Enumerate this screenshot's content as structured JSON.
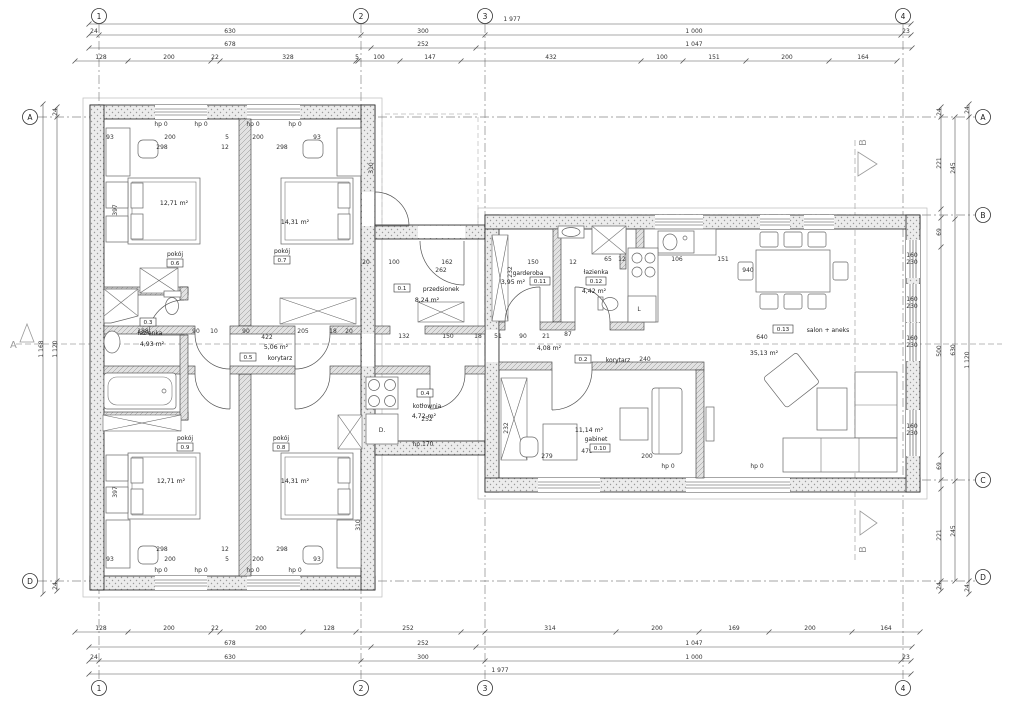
{
  "axes": {
    "cols": [
      "1",
      "2",
      "3",
      "4"
    ],
    "rows": [
      "A",
      "B",
      "C",
      "D"
    ]
  },
  "sections": {
    "a": "A",
    "b": "B"
  },
  "rooms": [
    {
      "id": "0.1",
      "name": "przedsionek",
      "area": "8,24 m²"
    },
    {
      "id": "0.2",
      "name": "korytarz",
      "area": "4,08 m²"
    },
    {
      "id": "0.3",
      "name": "łazienka",
      "area": "4,93 m²"
    },
    {
      "id": "0.4",
      "name": "kotłownia",
      "area": "4,72 m²"
    },
    {
      "id": "0.5",
      "name": "korytarz",
      "area": "5,06 m²"
    },
    {
      "id": "0.6",
      "name": "pokój",
      "area": "12,71 m²"
    },
    {
      "id": "0.7",
      "name": "pokój",
      "area": "14,31 m²"
    },
    {
      "id": "0.8",
      "name": "pokój",
      "area": "14,31 m²"
    },
    {
      "id": "0.9",
      "name": "pokój",
      "area": "12,71 m²"
    },
    {
      "id": "0.10",
      "name": "gabinet",
      "area": "11,14 m²"
    },
    {
      "id": "0.11",
      "name": "garderoba",
      "area": "3,95 m²"
    },
    {
      "id": "0.12",
      "name": "łazienka",
      "area": "4,42 m²"
    },
    {
      "id": "0.13",
      "name": "salon + aneks",
      "area": "35,13 m²"
    }
  ],
  "dims": {
    "texts": [
      [
        512,
        21,
        "1 977"
      ],
      [
        94,
        33,
        "24"
      ],
      [
        230,
        33,
        "630"
      ],
      [
        423,
        33,
        "300"
      ],
      [
        694,
        33,
        "1 000"
      ],
      [
        906,
        33,
        "23"
      ],
      [
        230,
        46,
        "678"
      ],
      [
        423,
        46,
        "252"
      ],
      [
        694,
        46,
        "1 047"
      ],
      [
        101,
        59,
        "128"
      ],
      [
        169,
        59,
        "200"
      ],
      [
        215,
        59,
        "22"
      ],
      [
        288,
        59,
        "328"
      ],
      [
        357,
        59,
        "5"
      ],
      [
        379,
        59,
        "100"
      ],
      [
        430,
        59,
        "147"
      ],
      [
        551,
        59,
        "432"
      ],
      [
        662,
        59,
        "100"
      ],
      [
        714,
        59,
        "151"
      ],
      [
        787,
        59,
        "200"
      ],
      [
        863,
        59,
        "164"
      ],
      [
        101,
        630,
        "128"
      ],
      [
        169,
        630,
        "200"
      ],
      [
        215,
        630,
        "22"
      ],
      [
        261,
        630,
        "200"
      ],
      [
        329,
        630,
        "128"
      ],
      [
        408,
        630,
        "252"
      ],
      [
        550,
        630,
        "314"
      ],
      [
        657,
        630,
        "200"
      ],
      [
        734,
        630,
        "169"
      ],
      [
        810,
        630,
        "200"
      ],
      [
        886,
        630,
        "164"
      ],
      [
        230,
        645,
        "678"
      ],
      [
        423,
        645,
        "252"
      ],
      [
        694,
        645,
        "1 047"
      ],
      [
        94,
        659,
        "24"
      ],
      [
        230,
        659,
        "630"
      ],
      [
        423,
        659,
        "300"
      ],
      [
        694,
        659,
        "1 000"
      ],
      [
        906,
        659,
        "23"
      ],
      [
        500,
        672,
        "1 977"
      ],
      [
        43,
        349,
        "1 168",
        1
      ],
      [
        57,
        349,
        "1 120",
        1
      ],
      [
        57,
        112,
        "24",
        1
      ],
      [
        57,
        586,
        "24",
        1
      ],
      [
        941,
        112,
        "24",
        1
      ],
      [
        941,
        163,
        "221",
        1
      ],
      [
        941,
        232,
        "69",
        1
      ],
      [
        941,
        351,
        "500",
        1
      ],
      [
        941,
        466,
        "69",
        1
      ],
      [
        941,
        535,
        "221",
        1
      ],
      [
        941,
        586,
        "24",
        1
      ],
      [
        955,
        168,
        "245",
        1
      ],
      [
        955,
        350,
        "630",
        1
      ],
      [
        955,
        531,
        "245",
        1
      ],
      [
        969,
        110,
        "24",
        1
      ],
      [
        969,
        360,
        "1 120",
        1
      ],
      [
        969,
        588,
        "24",
        1
      ],
      [
        912,
        257,
        "160"
      ],
      [
        912,
        264,
        "230"
      ],
      [
        912,
        301,
        "160"
      ],
      [
        912,
        308,
        "230"
      ],
      [
        912,
        340,
        "160"
      ],
      [
        912,
        347,
        "230"
      ],
      [
        912,
        428,
        "160"
      ],
      [
        912,
        435,
        "230"
      ],
      [
        161,
        126,
        "hp 0"
      ],
      [
        201,
        126,
        "hp 0"
      ],
      [
        253,
        126,
        "hp 0"
      ],
      [
        295,
        126,
        "hp 0"
      ],
      [
        161,
        572,
        "hp 0"
      ],
      [
        201,
        572,
        "hp 0"
      ],
      [
        253,
        572,
        "hp 0"
      ],
      [
        295,
        572,
        "hp 0"
      ],
      [
        668,
        468,
        "hp 0"
      ],
      [
        757,
        468,
        "hp 0"
      ],
      [
        423,
        446,
        "hp 170"
      ],
      [
        110,
        139,
        "93"
      ],
      [
        170,
        139,
        "200"
      ],
      [
        227,
        139,
        "5"
      ],
      [
        258,
        139,
        "200"
      ],
      [
        317,
        139,
        "93"
      ],
      [
        162,
        149,
        "298"
      ],
      [
        225,
        149,
        "12"
      ],
      [
        282,
        149,
        "298"
      ],
      [
        162,
        551,
        "298"
      ],
      [
        225,
        551,
        "12"
      ],
      [
        282,
        551,
        "298"
      ],
      [
        110,
        561,
        "93"
      ],
      [
        170,
        561,
        "200"
      ],
      [
        227,
        561,
        "5"
      ],
      [
        258,
        561,
        "200"
      ],
      [
        317,
        561,
        "93"
      ],
      [
        143,
        333,
        "188"
      ],
      [
        196,
        333,
        "90"
      ],
      [
        214,
        333,
        "10"
      ],
      [
        246,
        333,
        "90"
      ],
      [
        303,
        333,
        "205"
      ],
      [
        333,
        333,
        "18"
      ],
      [
        349,
        333,
        "20"
      ],
      [
        366,
        264,
        "20"
      ],
      [
        394,
        264,
        "100"
      ],
      [
        447,
        264,
        "162"
      ],
      [
        533,
        264,
        "150"
      ],
      [
        573,
        264,
        "12"
      ],
      [
        441,
        272,
        "262"
      ],
      [
        512,
        272,
        "232",
        1
      ],
      [
        404,
        338,
        "132"
      ],
      [
        448,
        338,
        "150"
      ],
      [
        478,
        338,
        "18"
      ],
      [
        498,
        338,
        "51"
      ],
      [
        523,
        338,
        "90"
      ],
      [
        546,
        338,
        "21"
      ],
      [
        568,
        336,
        "87"
      ],
      [
        645,
        361,
        "240"
      ],
      [
        267,
        339,
        "422"
      ],
      [
        608,
        261,
        "65"
      ],
      [
        622,
        261,
        "12"
      ],
      [
        677,
        261,
        "106"
      ],
      [
        723,
        261,
        "151"
      ],
      [
        427,
        421,
        "252"
      ],
      [
        382,
        432,
        "D."
      ],
      [
        639,
        311,
        "L"
      ],
      [
        547,
        458,
        "279"
      ],
      [
        587,
        453,
        "479"
      ],
      [
        647,
        458,
        "200"
      ],
      [
        508,
        428,
        "232",
        1
      ],
      [
        748,
        272,
        "940"
      ],
      [
        762,
        339,
        "640"
      ],
      [
        117,
        210,
        "397",
        1
      ],
      [
        117,
        492,
        "397",
        1
      ],
      [
        373,
        168,
        "310",
        1
      ],
      [
        360,
        525,
        "310",
        1
      ]
    ],
    "lines": [
      [
        "h",
        24,
        89,
        911,
        [
          89,
          911
        ]
      ],
      [
        "h",
        35,
        89,
        911,
        [
          89,
          99,
          361,
          485,
          901,
          911
        ]
      ],
      [
        "h",
        48,
        89,
        912,
        [
          89,
          371,
          476,
          912
        ]
      ],
      [
        "h",
        61,
        75,
        897,
        [
          75,
          128,
          211,
          220,
          356,
          358,
          400,
          461,
          641,
          683,
          746,
          829,
          897
        ]
      ],
      [
        "h",
        632,
        75,
        920,
        [
          75,
          128,
          211,
          220,
          303,
          356,
          461,
          485,
          616,
          699,
          769,
          852,
          920
        ]
      ],
      [
        "h",
        647,
        89,
        912,
        [
          89,
          371,
          476,
          912
        ]
      ],
      [
        "h",
        661,
        89,
        911,
        [
          89,
          99,
          361,
          485,
          901,
          911
        ]
      ],
      [
        "h",
        674,
        89,
        911,
        [
          89,
          911
        ]
      ],
      [
        "v",
        43,
        104,
        594,
        [
          104,
          594
        ]
      ],
      [
        "v",
        57,
        107,
        591,
        [
          107,
          117,
          581,
          591
        ]
      ],
      [
        "v",
        941,
        107,
        591,
        [
          107,
          117,
          209,
          218,
          247,
          455,
          480,
          489,
          581,
          591
        ]
      ],
      [
        "v",
        955,
        117,
        581,
        [
          117,
          219,
          481,
          581
        ]
      ],
      [
        "v",
        969,
        104,
        594,
        [
          104,
          117,
          581,
          594
        ]
      ]
    ]
  }
}
